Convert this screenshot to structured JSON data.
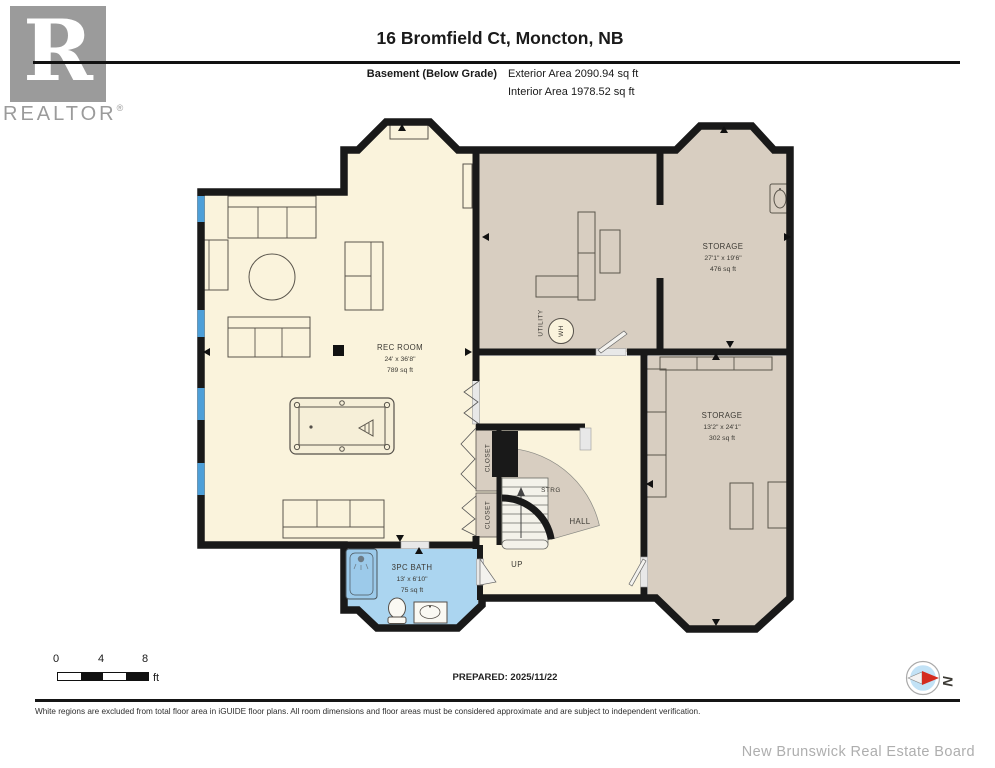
{
  "header": {
    "logo_letter": "R",
    "logo_brand": "REALTOR",
    "logo_reg": "®",
    "title": "16 Bromfield Ct, Moncton, NB",
    "floor_label": "Basement (Below Grade)",
    "exterior_area": "Exterior Area 2090.94 sq ft",
    "interior_area": "Interior Area 1978.52 sq ft"
  },
  "plan": {
    "rec": {
      "name": "REC ROOM",
      "dim": "24' x 36'8\"",
      "area": "789 sq ft"
    },
    "storage1": {
      "name": "STORAGE",
      "dim": "27'1\" x 19'6\"",
      "area": "476 sq ft"
    },
    "storage2": {
      "name": "STORAGE",
      "dim": "13'2\" x 24'1\"",
      "area": "302 sq ft"
    },
    "bath": {
      "name": "3PC BATH",
      "dim": "13' x 6'10\"",
      "area": "75 sq ft"
    },
    "hall": {
      "name": "HALL"
    },
    "up": {
      "label": "UP"
    },
    "strg": {
      "label": "STRG"
    },
    "utility": {
      "label": "UTILITY"
    },
    "wh": {
      "label": "WH"
    },
    "closet": {
      "label": "CLOSET"
    },
    "colors": {
      "floor_cream": "#FAF3DC",
      "floor_tan": "#D8CEC1",
      "floor_bath": "#ABD5F0",
      "wall": "#191919",
      "window_blue": "#4D9FD8"
    }
  },
  "footer": {
    "scale": {
      "n0": "0",
      "n4": "4",
      "n8": "8",
      "unit": "ft"
    },
    "prepared": "PREPARED: 2025/11/22",
    "compass_letter": "N",
    "disclaimer": "White regions are excluded from total floor area in iGUIDE floor plans. All room dimensions and floor areas must be considered approximate and are subject to independent verification.",
    "board": "New Brunswick Real Estate Board"
  }
}
